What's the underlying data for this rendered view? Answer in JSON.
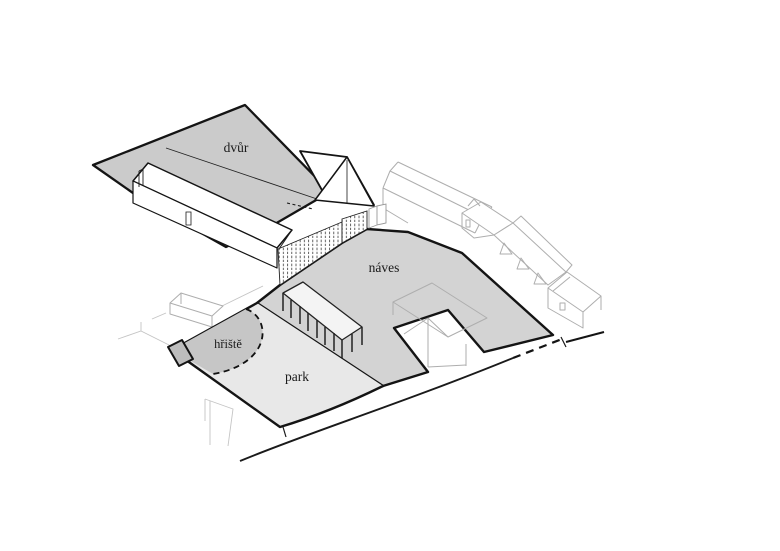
{
  "diagram": {
    "labels": {
      "dvur": "dvůr",
      "naves": "náves",
      "hriste": "hřiště",
      "park": "park"
    },
    "colors": {
      "background": "#ffffff",
      "dvur": "#cbcbcb",
      "naves": "#d3d3d3",
      "hriste": "#c6c6c6",
      "park": "#e8e8e8",
      "step": "#bdbdbd",
      "pergola_roof": "#f4f4f4",
      "outline": "#141414",
      "context_line": "#aeaeae"
    }
  }
}
